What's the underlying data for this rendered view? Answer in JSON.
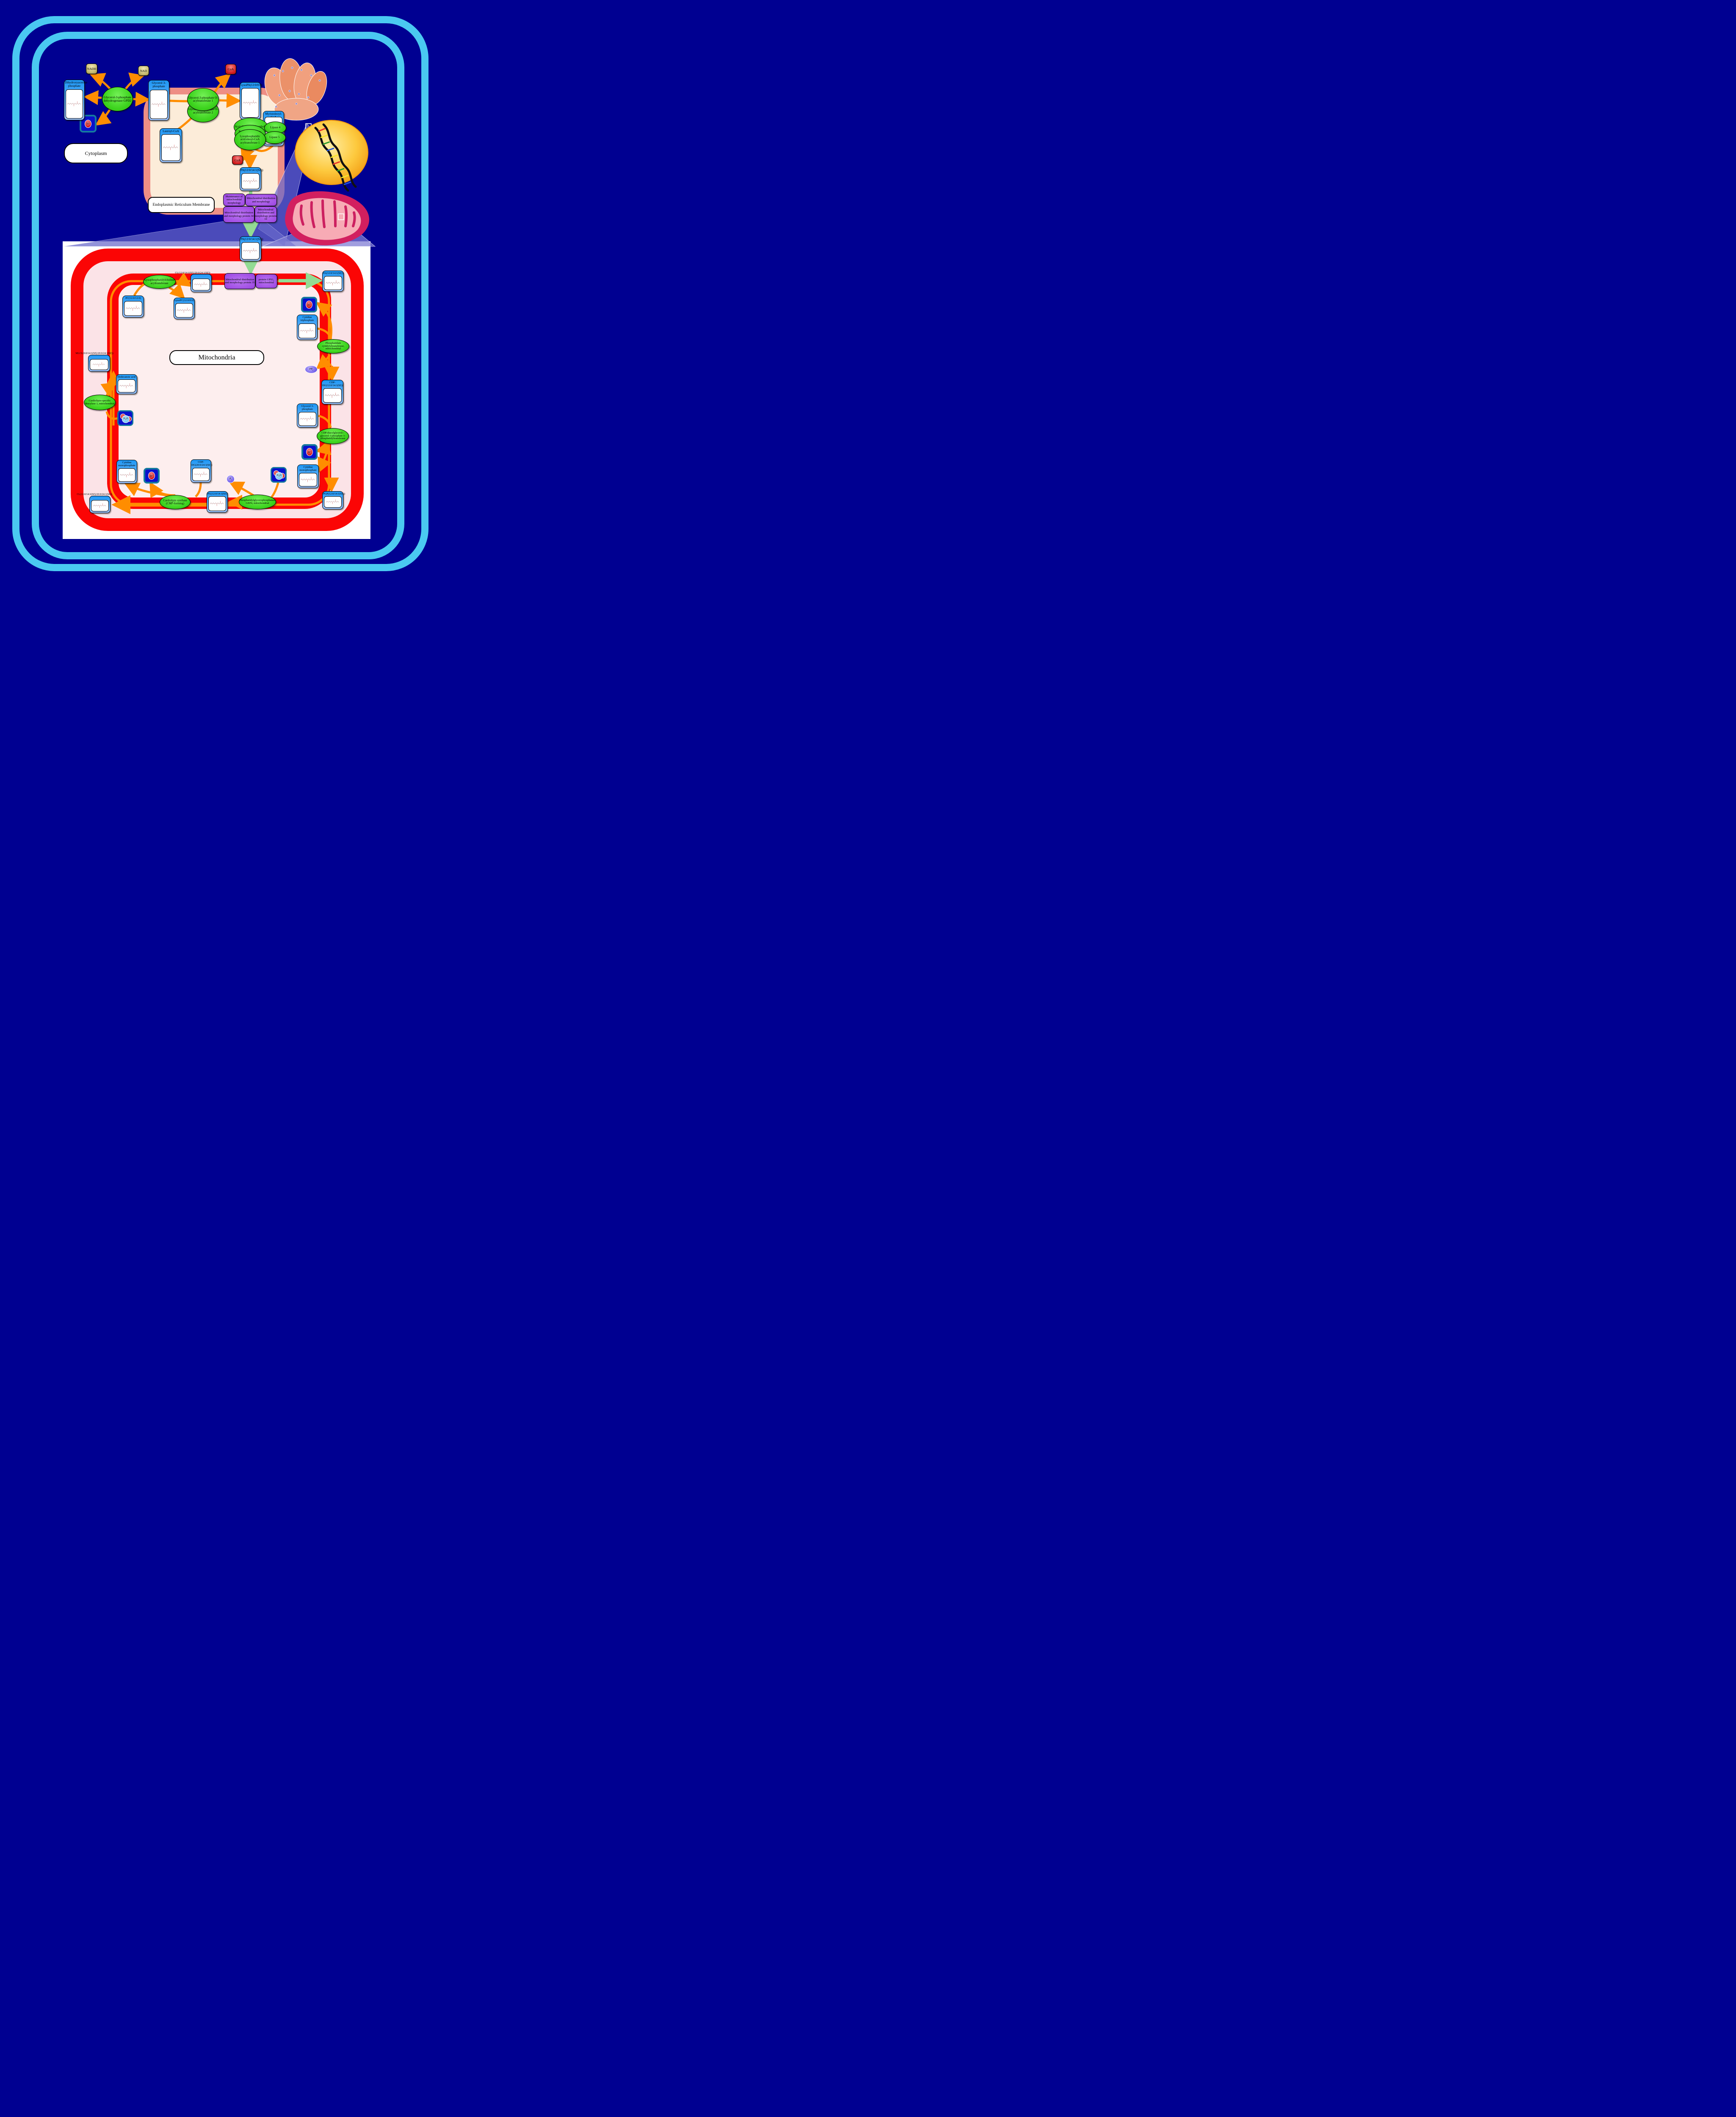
{
  "regions": {
    "cytoplasm": "Cytoplasm",
    "er": "Endoplasmic Reticulum Membrane",
    "mitochondria": "Mitochondria"
  },
  "metabolites": {
    "dhap": "Dihydroxyacetone phosphate",
    "g3p_er": "Glycerol 3-phosphate",
    "lauroyl_coa": "Lauroyl-CoA",
    "lysopa": "LysoPA(12:0/0:0)",
    "myristoleoyl_coa": "Myristoleoyl-CoA",
    "pa_er": "PA(12:0/14:1(9Z))",
    "pa_omm": "PA(12:0/14:1(9Z))",
    "pa_imm": "PA(12:0/14:1(9Z))",
    "cl_top": "CL(12:0/14:1(9Z)/20:0/24:1(9Z))",
    "pc": "PC(12:0/12:0)",
    "lysopc": "LysoPC(12:0/0:0)",
    "mlcl": "MLCL(0:0/14:1(9Z)/20:0/24:1(9Z))",
    "dodecanoic": "Dodecanoic acid",
    "ctp": "Cytidine triphosphate",
    "cdp_dg_1": "CDP-DG(12:0/14:1(9Z))",
    "g3p_mito": "Glycerol 3-phosphate",
    "cmp_right": "Cytidine monophosphate",
    "pgp": "PGP(12:0/14:1(9Z))",
    "pg": "PG(12:0/14:1(9Z))",
    "cdp_dg_2": "CDP-DG(20:0/24:1(9Z))",
    "cmp_left": "Cytidine monophosphate",
    "cl_bottom": "CL(12:0/14:1(9Z)/20:0/24:1(9Z))"
  },
  "enzymes": {
    "gpd2": "Glycerol-3-phosphate dehydrogenase GPD2",
    "gpat1": "Glycerol-3-phosphate O-acyltransferase 1",
    "gpat2": "Glycerol-3-phosphate O-acyltransferase 2",
    "acyl_lyso": "Acyl-CoA:lyso-phospholip",
    "lipase4": "Lipase 4",
    "probable": "Probable 1-acyl-sn-glycerol-3",
    "lipase5": "Lipase 5",
    "lpaat1": "Lysophosphatidic acid:oleoyl-CoA acyltransferase 1",
    "lpcat": "Lysophosphatidylcholine acyltransferase",
    "csd1": "Cardiolipin-specific deacylase 1, mitochondrial",
    "pct": "Phosphatidate cytidylyltransferase, mitochondrial",
    "cdppgs": "CDP-diacylglycerol--glycerol-3-phosphate 3-phosphatidyltransferase",
    "gep4": "Phosphatidylglycerophosphatase GEP4, mitochondrial",
    "cls": "Cardiolipin synthase (CMP-forming)"
  },
  "proteins": {
    "mmm1": "Maintenance of mitochondrial morphology",
    "mdm": "Mitochondrial distribution and morphology",
    "mdm34": "Mitochondrial distribution and morphology protein 34",
    "mdm10": "Mitochondrial distribution and morphology protein 10",
    "mdm35": "Mitochondrial distribution and morphology protein 35",
    "ups1": "protein UPS1, mitochondrial"
  },
  "small": {
    "nadh": "NADH",
    "nad": "NAD",
    "coa": "CoA",
    "h": "H",
    "plus": "+",
    "h2o_h": "H",
    "h2o_sub": "2",
    "h2o_o": "O",
    "p": "P",
    "p_sub": "i",
    "pp": "PP",
    "pp_sub": "i"
  },
  "colors": {
    "background": "#000091",
    "frame_cyan": "#4ac9f1",
    "membrane_red": "#fb0505",
    "er_salmon": "#ee8e85",
    "er_cream": "#fcecd9",
    "node_blue": "#2196f3",
    "enzyme_green": "#3ed41f",
    "protein_purple": "#a14ee4",
    "arrow_orange": "#ff8d00",
    "arrow_green": "#93db93"
  }
}
